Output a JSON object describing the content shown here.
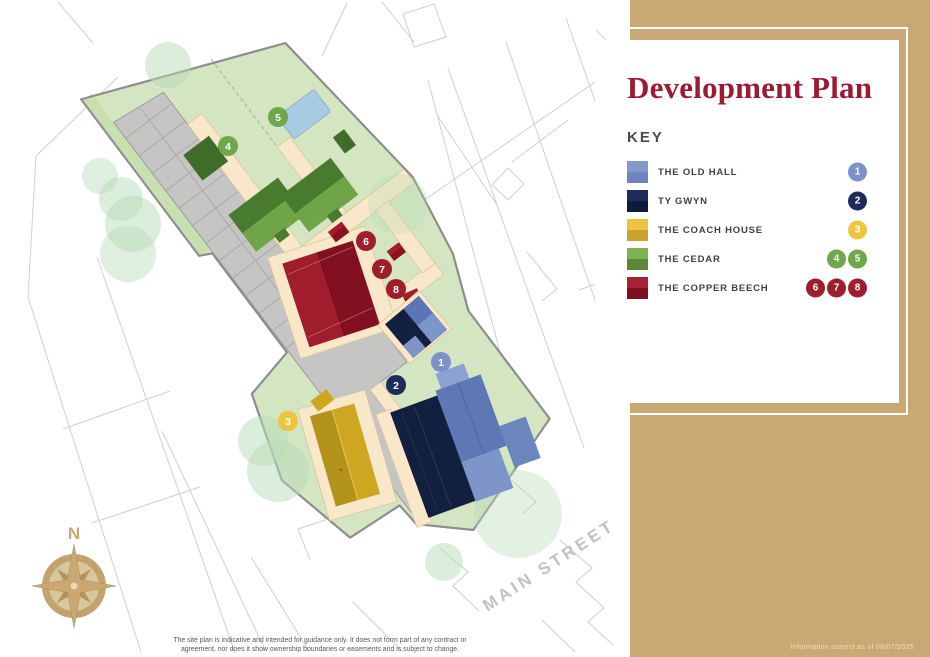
{
  "panel": {
    "title": "Development Plan",
    "key_heading": "KEY",
    "background_color": "#c9a873",
    "title_color": "#9c1b31"
  },
  "legend": {
    "items": [
      {
        "label": "THE OLD HALL",
        "swatch_top": "#8498cd",
        "swatch_bottom": "#6f85be",
        "badge_color": "#7b92cb",
        "badges": [
          "1"
        ]
      },
      {
        "label": "TY GWYN",
        "swatch_top": "#1c2b59",
        "swatch_bottom": "#0d1c3c",
        "badge_color": "#1d2c5a",
        "badges": [
          "2"
        ]
      },
      {
        "label": "THE COACH HOUSE",
        "swatch_top": "#eec33e",
        "swatch_bottom": "#c9a42c",
        "badge_color": "#efc53e",
        "badges": [
          "3"
        ]
      },
      {
        "label": "THE CEDAR",
        "swatch_top": "#7cb351",
        "swatch_bottom": "#5a8a39",
        "badge_color": "#6fa74a",
        "badges": [
          "4",
          "5"
        ]
      },
      {
        "label": "THE COPPER BEECH",
        "swatch_top": "#a42233",
        "swatch_bottom": "#7d0f21",
        "badge_color": "#9e1e2b",
        "badges": [
          "6",
          "7",
          "8"
        ]
      }
    ]
  },
  "map": {
    "street_label": "MAIN STREET",
    "compass_n": "N",
    "markers": [
      {
        "label": "1",
        "color": "#7b92cb"
      },
      {
        "label": "2",
        "color": "#1d2c5a"
      },
      {
        "label": "3",
        "color": "#eec33e"
      },
      {
        "label": "4",
        "color": "#6fa74a"
      },
      {
        "label": "5",
        "color": "#6fa74a"
      },
      {
        "label": "6",
        "color": "#9e1e2b"
      },
      {
        "label": "7",
        "color": "#9e1e2b"
      },
      {
        "label": "8",
        "color": "#9e1e2b"
      }
    ],
    "palette": {
      "plot_green": "#d3e5c1",
      "road_gray": "#c5c6c3",
      "path_cream": "#f8e8c9",
      "pond_blue": "#a9cbe2",
      "tree_green": "#b7dcb7",
      "compass_gold": "#c9a873"
    }
  },
  "footer": {
    "disclaimer_line1": "The site plan is indicative and intended for guidance only.  It does not form part of any contract or",
    "disclaimer_line2": "agreement, nor does it show ownership boundaries or easements and is subject to change.",
    "info_note": "Information correct as of 08/07/2025"
  }
}
